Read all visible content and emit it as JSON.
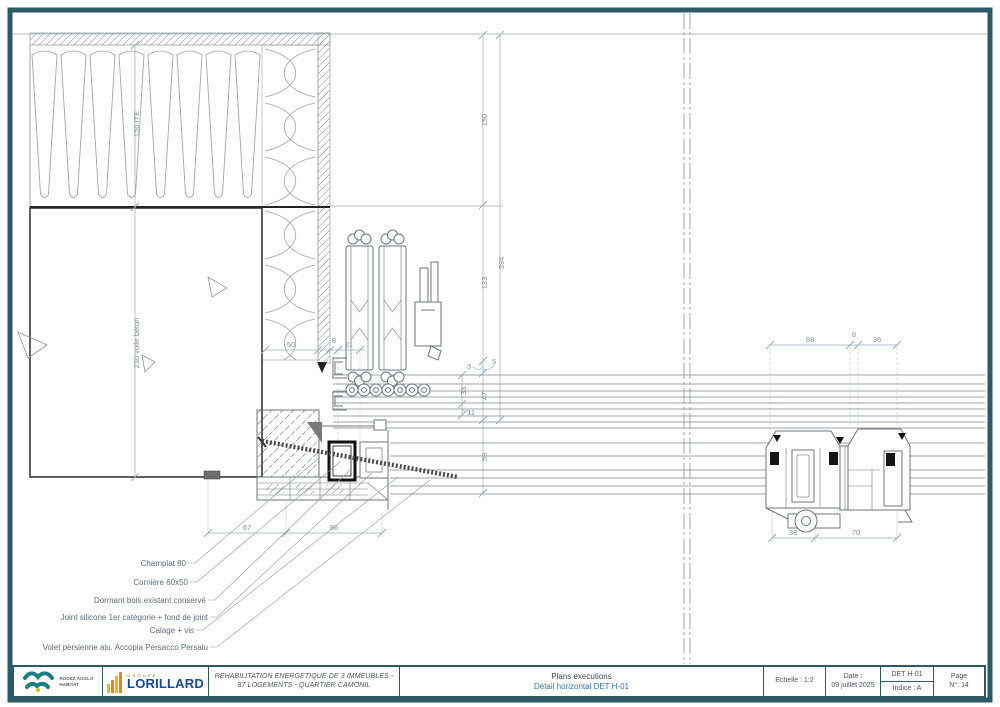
{
  "drawing": {
    "ite_label": "150 ITE",
    "wall_label": "230 voile béton",
    "dims": {
      "d150": "150",
      "d394": "394",
      "d133": "133",
      "d3": "3",
      "d5": "5",
      "d33": "33",
      "d47": "47",
      "d11": "11",
      "d59": "59",
      "d50": "50",
      "d8a": "8",
      "d21": "21",
      "d67": "67",
      "d86": "86",
      "d68": "68",
      "d8b": "8",
      "d36": "36",
      "d38": "38",
      "d70": "70"
    },
    "callouts": [
      "Champlat 80",
      "Cornière 60x50",
      "Dormant bois existant conservé",
      "Joint silicone 1er catégorie + fond de joint",
      "Calage + vis",
      "Volet persienne alu. Accopla Persacco Persalu"
    ]
  },
  "title_block": {
    "logo1_line1": "RODEZ AGGLO",
    "logo1_line2": "HABITAT",
    "logo2_top": "GROUPE",
    "logo2_main": "LORILLARD",
    "project_line1": "REHABILITATION ENERGETIQUE DE 3 IMMEUBLES -",
    "project_line2": "87 LOGEMENTS - QUARTIER CAMONIL",
    "doc_line1": "Plans executions",
    "doc_line2": "Détail horizontal DET H-01",
    "scale": "Echelle : 1:2",
    "date_label": "Date :",
    "date_value": "09 juillet 2025",
    "ref": "DET H-01",
    "indice": "Indice : A",
    "page_label": "Page",
    "page_value": "N°: 14"
  }
}
